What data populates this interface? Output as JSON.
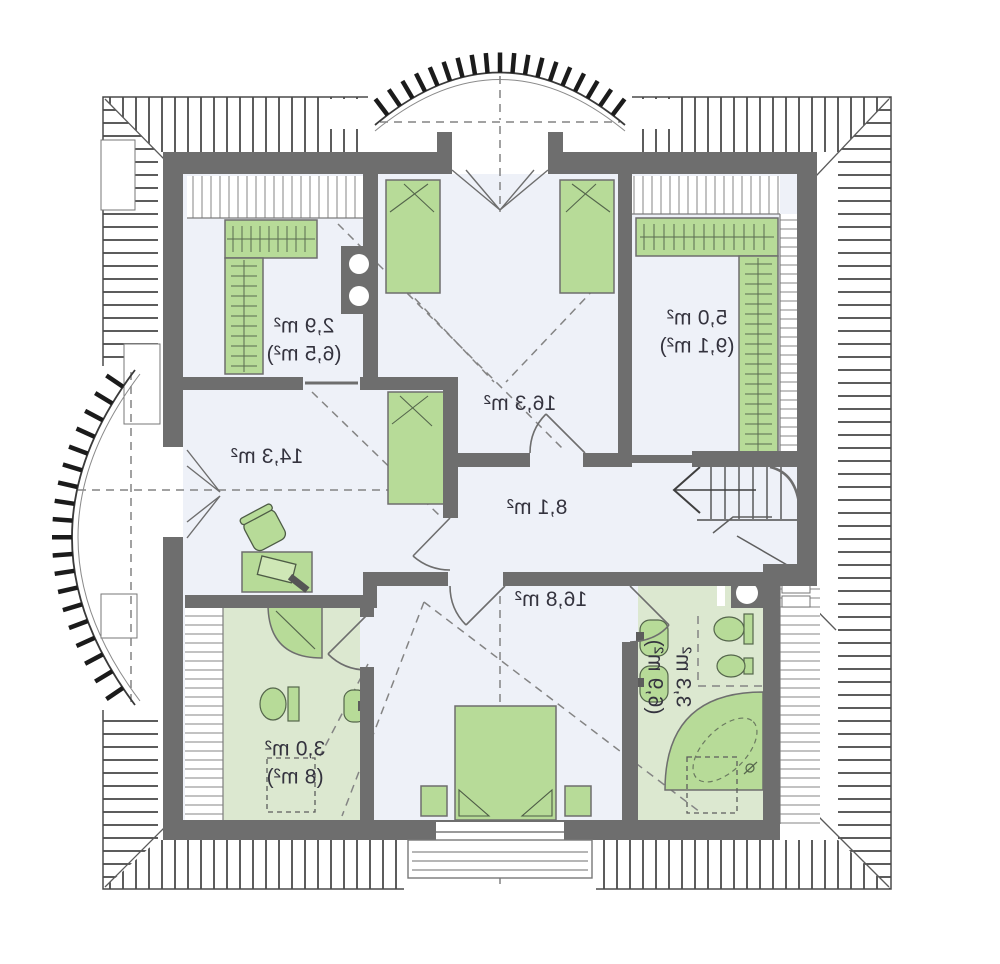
{
  "plan": {
    "type": "attic-floor-plan",
    "mirrored": true,
    "rooms": [
      {
        "key": "closet-top-left",
        "area": "2,9 m²",
        "total_area": "(6,5 m²)"
      },
      {
        "key": "bedroom-top",
        "area": "16,3 m²",
        "total_area": ""
      },
      {
        "key": "closet-top-right",
        "area": "5,0 m²",
        "total_area": "(9,1 m²)"
      },
      {
        "key": "bedroom-left",
        "area": "14,3 m²",
        "total_area": ""
      },
      {
        "key": "hall",
        "area": "8,1 m²",
        "total_area": ""
      },
      {
        "key": "bedroom-bottom",
        "area": "16,8 m²",
        "total_area": ""
      },
      {
        "key": "bathroom-left",
        "area": "3,0 m²",
        "total_area": "(8 m²)"
      },
      {
        "key": "bathroom-right",
        "area": "3,3 m²",
        "total_area": "(6,9 m²)"
      }
    ],
    "colors": {
      "wall": "#6e6e6e",
      "floor": "#eef1f8",
      "green_room_floor": "#dce8d0",
      "furniture_green": "#b7db98",
      "roof_hatch": "#3f3f3f",
      "dashed_line": "#848484",
      "label_text": "#34333e"
    }
  }
}
